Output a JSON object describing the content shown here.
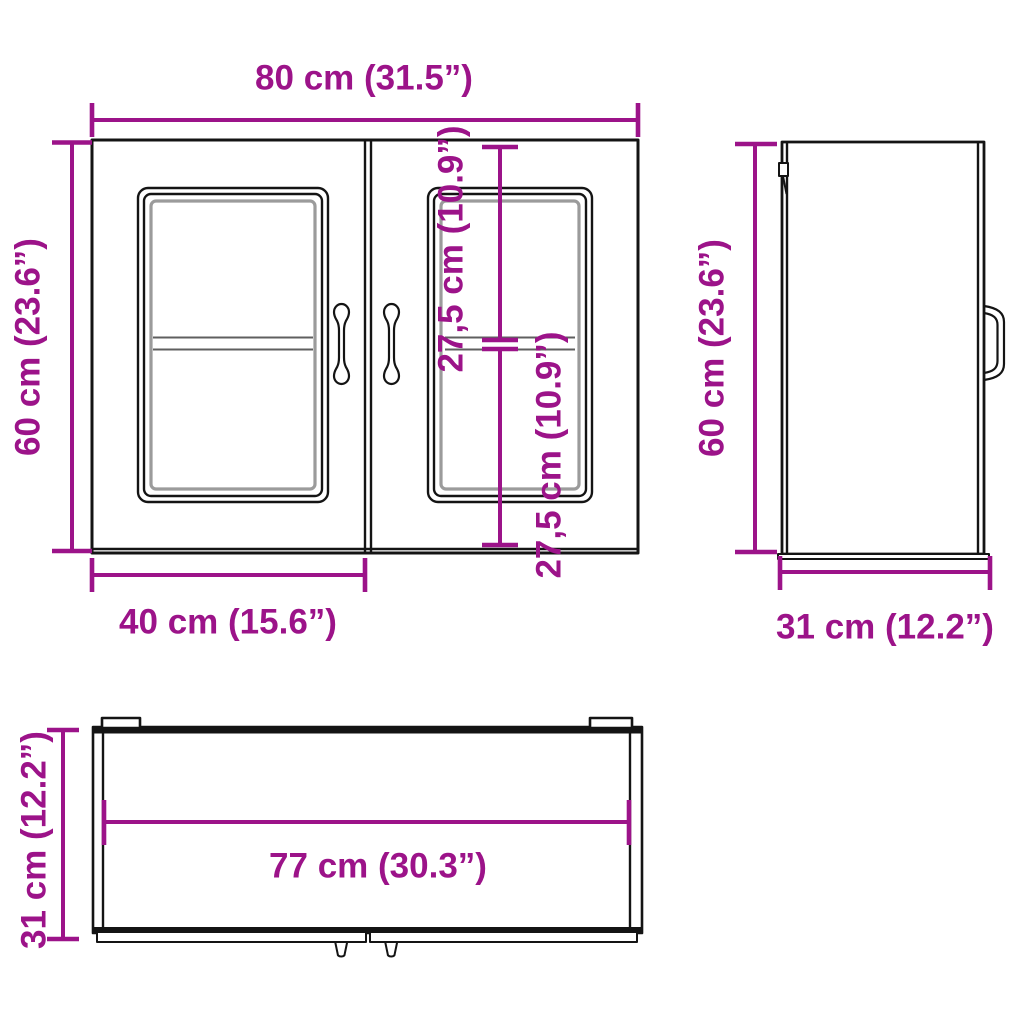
{
  "colors": {
    "dimension": "#9c1389",
    "outline": "#141414"
  },
  "diagram": {
    "front_view": {
      "width_label": "80 cm (31.5”)",
      "height_label": "60 cm (23.6”)",
      "door_width_label": "40 cm (15.6”)",
      "upper_section_label": "27,5 cm (10.9”)",
      "lower_section_label": "27,5 cm (10.9”)"
    },
    "side_view": {
      "height_label": "60 cm (23.6”)",
      "depth_label": "31 cm (12.2”)"
    },
    "top_view": {
      "inner_width_label": "77 cm (30.3”)",
      "depth_label": "31 cm (12.2”)"
    }
  }
}
